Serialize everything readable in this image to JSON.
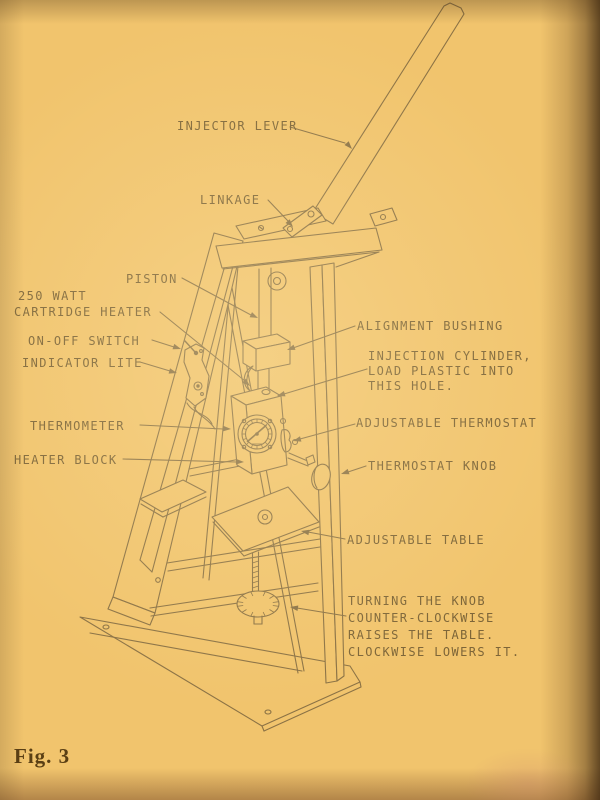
{
  "page": {
    "caption": "Fig. 3",
    "colors": {
      "paper": "#f1c46d",
      "ink_line": "#8b7245",
      "label_text": "#7d6538",
      "caption_ink": "#5a3f14",
      "edge_shadow": "#5c3c18"
    }
  },
  "labels": {
    "injector_lever": [
      "INJECTOR LEVER"
    ],
    "linkage": [
      "LINKAGE"
    ],
    "piston": [
      "PISTON"
    ],
    "cartridge_heater": [
      "250 WATT",
      "CARTRIDGE HEATER"
    ],
    "on_off_switch": [
      "ON-OFF SWITCH"
    ],
    "indicator_lite": [
      "INDICATOR LITE"
    ],
    "thermometer": [
      "THERMOMETER"
    ],
    "heater_block": [
      "HEATER BLOCK"
    ],
    "alignment_bushing": [
      "ALIGNMENT BUSHING"
    ],
    "injection_cylinder": [
      "INJECTION CYLINDER,",
      "LOAD PLASTIC INTO",
      "THIS HOLE."
    ],
    "adjustable_thermostat": [
      "ADJUSTABLE THERMOSTAT"
    ],
    "thermostat_knob": [
      "THERMOSTAT KNOB"
    ],
    "adjustable_table": [
      "ADJUSTABLE TABLE"
    ],
    "knob_note": [
      "TURNING THE KNOB",
      "COUNTER-CLOCKWISE",
      "RAISES THE TABLE.",
      "CLOCKWISE LOWERS IT."
    ]
  }
}
